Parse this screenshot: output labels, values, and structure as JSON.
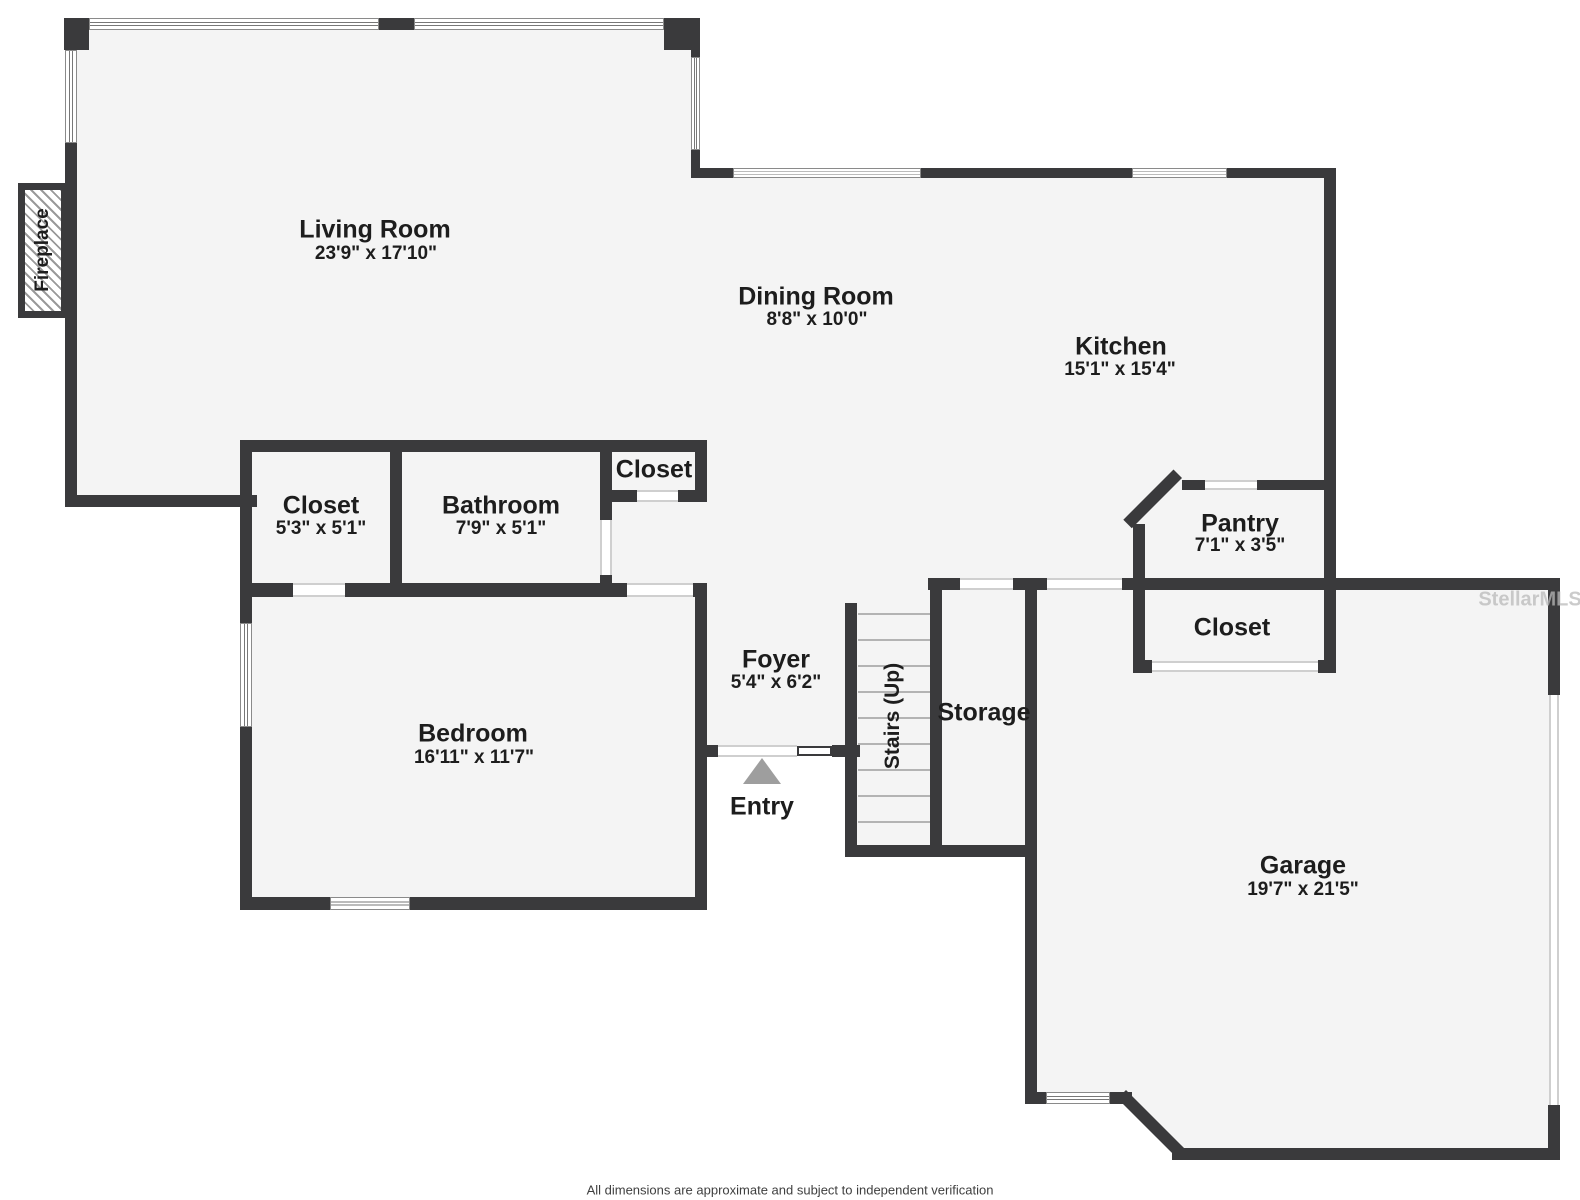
{
  "meta": {
    "watermark": "StellarMLS",
    "disclaimer": "All dimensions are approximate and subject to independent verification"
  },
  "rooms": {
    "living_room": {
      "name": "Living Room",
      "dims": "23'9\" x 17'10\""
    },
    "dining_room": {
      "name": "Dining Room",
      "dims": "8'8\" x 10'0\""
    },
    "kitchen": {
      "name": "Kitchen",
      "dims": "15'1\" x 15'4\""
    },
    "pantry": {
      "name": "Pantry",
      "dims": "7'1\" x 3'5\""
    },
    "garage_closet": {
      "name": "Closet"
    },
    "storage": {
      "name": "Storage"
    },
    "stairs": {
      "name": "Stairs (Up)"
    },
    "foyer": {
      "name": "Foyer",
      "dims": "5'4\" x 6'2\""
    },
    "entry": {
      "name": "Entry"
    },
    "bedroom": {
      "name": "Bedroom",
      "dims": "16'11\" x 11'7\""
    },
    "bedroom_closet": {
      "name": "Closet",
      "dims": "5'3\" x 5'1\""
    },
    "bathroom": {
      "name": "Bathroom",
      "dims": "7'9\" x 5'1\""
    },
    "hall_closet": {
      "name": "Closet"
    },
    "garage": {
      "name": "Garage",
      "dims": "19'7\" x 21'5\""
    },
    "fireplace": {
      "name": "Fireplace"
    }
  }
}
